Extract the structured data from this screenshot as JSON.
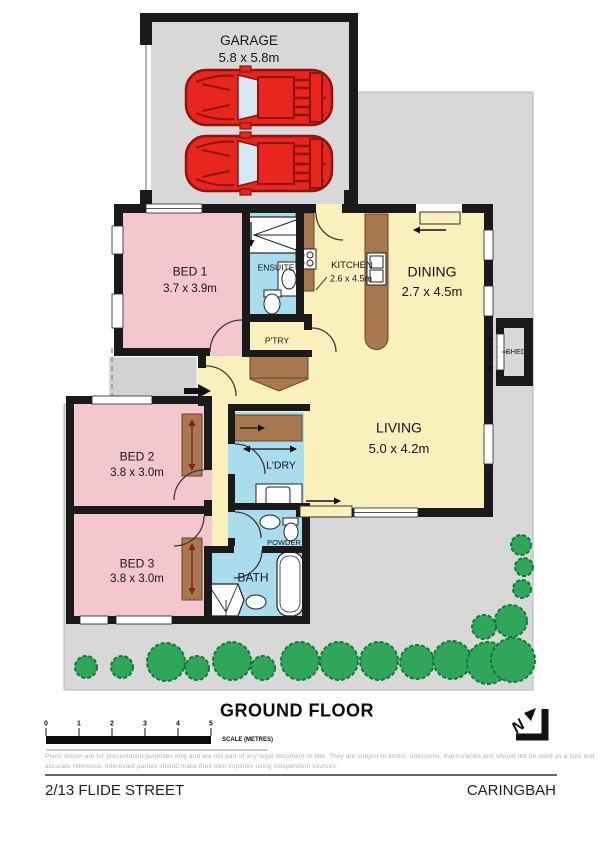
{
  "plan": {
    "title": "GROUND FLOOR",
    "address": "2/13 FLIDE STREET",
    "suburb": "CARINGBAH",
    "north_label": "N",
    "scale_bar": {
      "ticks": [
        "0",
        "1",
        "2",
        "3",
        "4",
        "5"
      ],
      "label": "SCALE (METRES)"
    },
    "disclaimer": {
      "line1": "Plans shown are for presentation purposes only and are not part of any legal document or title. They are subject to errors, omissions, inaccuracies and should not be used as a size and",
      "line2": "accurate reference. Interested parties should make their own inquiries using independent sources."
    },
    "rooms": {
      "garage": {
        "name": "GARAGE",
        "dims": "5.8 x 5.8m"
      },
      "bed1": {
        "name": "BED 1",
        "dims": "3.7 x 3.9m"
      },
      "ensuite": {
        "name": "ENSUITE"
      },
      "kitchen": {
        "name": "KITCHEN",
        "dims": "2.6 x 4.5m"
      },
      "dining": {
        "name": "DINING",
        "dims": "2.7 x 4.5m"
      },
      "pantry": {
        "name": "P'TRY"
      },
      "shed": {
        "name": "SHED"
      },
      "living": {
        "name": "LIVING",
        "dims": "5.0 x 4.2m"
      },
      "bed2": {
        "name": "BED 2",
        "dims": "3.8 x 3.0m"
      },
      "laundry": {
        "name": "L'DRY"
      },
      "powder": {
        "name": "POWDER"
      },
      "bed3": {
        "name": "BED 3",
        "dims": "3.8 x 3.0m"
      },
      "bath": {
        "name": "BATH"
      }
    },
    "colors": {
      "site": "#d8d8d8",
      "wall": "#1a1a1a",
      "bedroom": "#f4c7ce",
      "living_area": "#faf0bc",
      "wet_area": "#a9dcec",
      "joinery": "#a87950",
      "car": "#e8251f",
      "tree": "#2fa65a"
    }
  }
}
